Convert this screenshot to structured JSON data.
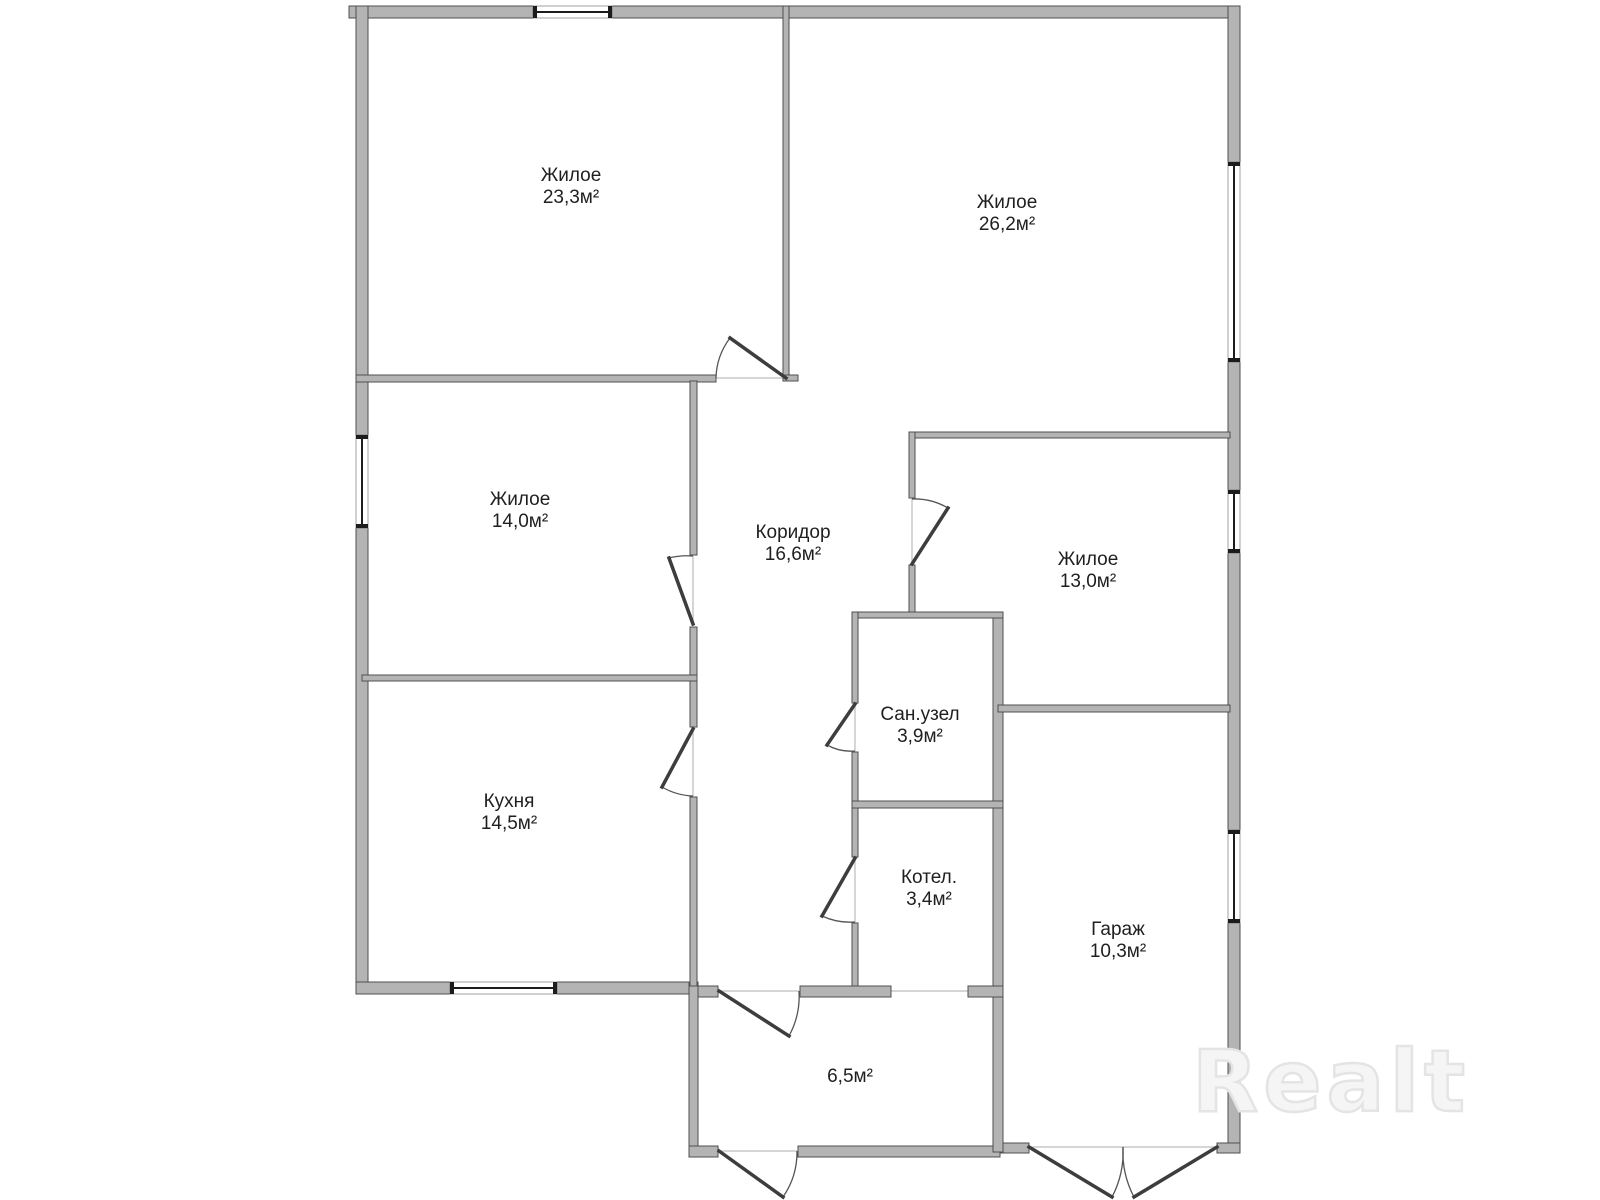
{
  "watermark": {
    "text": "Realt"
  },
  "rooms": [
    {
      "name": "Жилое",
      "area": "23,3м²",
      "cx": 571,
      "cy": 187
    },
    {
      "name": "Жилое",
      "area": "26,2м²",
      "cx": 1007,
      "cy": 214
    },
    {
      "name": "Жилое",
      "area": "14,0м²",
      "cx": 520,
      "cy": 511
    },
    {
      "name": "Коридор",
      "area": "16,6м²",
      "cx": 793,
      "cy": 544
    },
    {
      "name": "Жилое",
      "area": "13,0м²",
      "cx": 1088,
      "cy": 571
    },
    {
      "name": "Сан.узел",
      "area": "3,9м²",
      "cx": 920,
      "cy": 726
    },
    {
      "name": "Кухня",
      "area": "14,5м²",
      "cx": 509,
      "cy": 813
    },
    {
      "name": "Котел.",
      "area": "3,4м²",
      "cx": 929,
      "cy": 889
    },
    {
      "name": "Гараж",
      "area": "10,3м²",
      "cx": 1118,
      "cy": 941
    },
    {
      "name": "",
      "area": "6,5м²",
      "cx": 850,
      "cy": 1077
    }
  ],
  "colors": {
    "wall_fill": "#b4b4b4",
    "wall_stroke": "#4f4f4f",
    "door_leaf": "#3d3d3d",
    "door_arc": "#555555",
    "window_line": "#1c1c1c",
    "window_edge": "#8a8a8a",
    "threshold": "#c9c9c9",
    "label_text": "#1f1f1f",
    "watermark": "#e4e4e4"
  },
  "floorplan": {
    "walls": [
      [
        349,
        6,
        184,
        12
      ],
      [
        612,
        6,
        628,
        12
      ],
      [
        356,
        6,
        12,
        429
      ],
      [
        356,
        528,
        12,
        465
      ],
      [
        1228,
        6,
        12,
        156
      ],
      [
        1228,
        362,
        12,
        128
      ],
      [
        1228,
        553,
        12,
        277
      ],
      [
        1228,
        923,
        12,
        229
      ],
      [
        356,
        982,
        94,
        12
      ],
      [
        557,
        982,
        141,
        12
      ],
      [
        689,
        982,
        9,
        175
      ],
      [
        689,
        1146,
        29,
        11
      ],
      [
        798,
        1146,
        202,
        11
      ],
      [
        1000,
        1143,
        29,
        10
      ],
      [
        1217,
        1143,
        23,
        10
      ],
      [
        993,
        612,
        10,
        540
      ],
      [
        356,
        375,
        360,
        7
      ],
      [
        783,
        375,
        15,
        6
      ],
      [
        783,
        6,
        6,
        369
      ],
      [
        690,
        381,
        7,
        174
      ],
      [
        690,
        627,
        7,
        100
      ],
      [
        690,
        797,
        7,
        189
      ],
      [
        362,
        675,
        335,
        6
      ],
      [
        909,
        432,
        321,
        6
      ],
      [
        909,
        432,
        6,
        66
      ],
      [
        909,
        565,
        6,
        48
      ],
      [
        852,
        612,
        151,
        6
      ],
      [
        852,
        612,
        6,
        91
      ],
      [
        852,
        752,
        6,
        105
      ],
      [
        852,
        923,
        6,
        74
      ],
      [
        852,
        801,
        151,
        7
      ],
      [
        698,
        986,
        20,
        11
      ],
      [
        800,
        986,
        91,
        11
      ],
      [
        968,
        986,
        35,
        11
      ],
      [
        998,
        705,
        232,
        7
      ]
    ],
    "windows": [
      [
        533,
        6,
        79,
        12,
        "h"
      ],
      [
        356,
        435,
        12,
        93,
        "v"
      ],
      [
        1228,
        162,
        12,
        200,
        "v"
      ],
      [
        1228,
        490,
        12,
        63,
        "v"
      ],
      [
        1228,
        830,
        12,
        93,
        "v"
      ],
      [
        450,
        982,
        107,
        12,
        "h"
      ]
    ],
    "doors": [
      [
        786,
        378,
        730,
        338,
        716,
        378,
        0
      ],
      [
        693,
        624,
        669,
        558,
        693,
        556,
        1
      ],
      [
        693,
        729,
        662,
        787,
        693,
        796,
        0
      ],
      [
        912,
        564,
        948,
        508,
        912,
        499,
        0
      ],
      [
        855,
        704,
        827,
        745,
        855,
        751,
        0
      ],
      [
        855,
        858,
        822,
        916,
        855,
        922,
        0
      ],
      [
        719,
        991,
        789,
        1036,
        799,
        991,
        0
      ],
      [
        719,
        1151,
        783,
        1197,
        797,
        1151,
        0
      ],
      [
        1029,
        1147,
        1112,
        1197,
        1123,
        1147,
        0
      ],
      [
        1217,
        1147,
        1134,
        1197,
        1123,
        1147,
        1
      ]
    ],
    "thresholds": [
      [
        716,
        378,
        786,
        378
      ],
      [
        693,
        556,
        693,
        624
      ],
      [
        693,
        729,
        693,
        796
      ],
      [
        912,
        499,
        912,
        564
      ],
      [
        855,
        704,
        855,
        751
      ],
      [
        855,
        858,
        855,
        922
      ],
      [
        719,
        991,
        799,
        991
      ],
      [
        891,
        991,
        968,
        991
      ],
      [
        719,
        1151,
        797,
        1151
      ],
      [
        1029,
        1147,
        1217,
        1147
      ]
    ]
  }
}
